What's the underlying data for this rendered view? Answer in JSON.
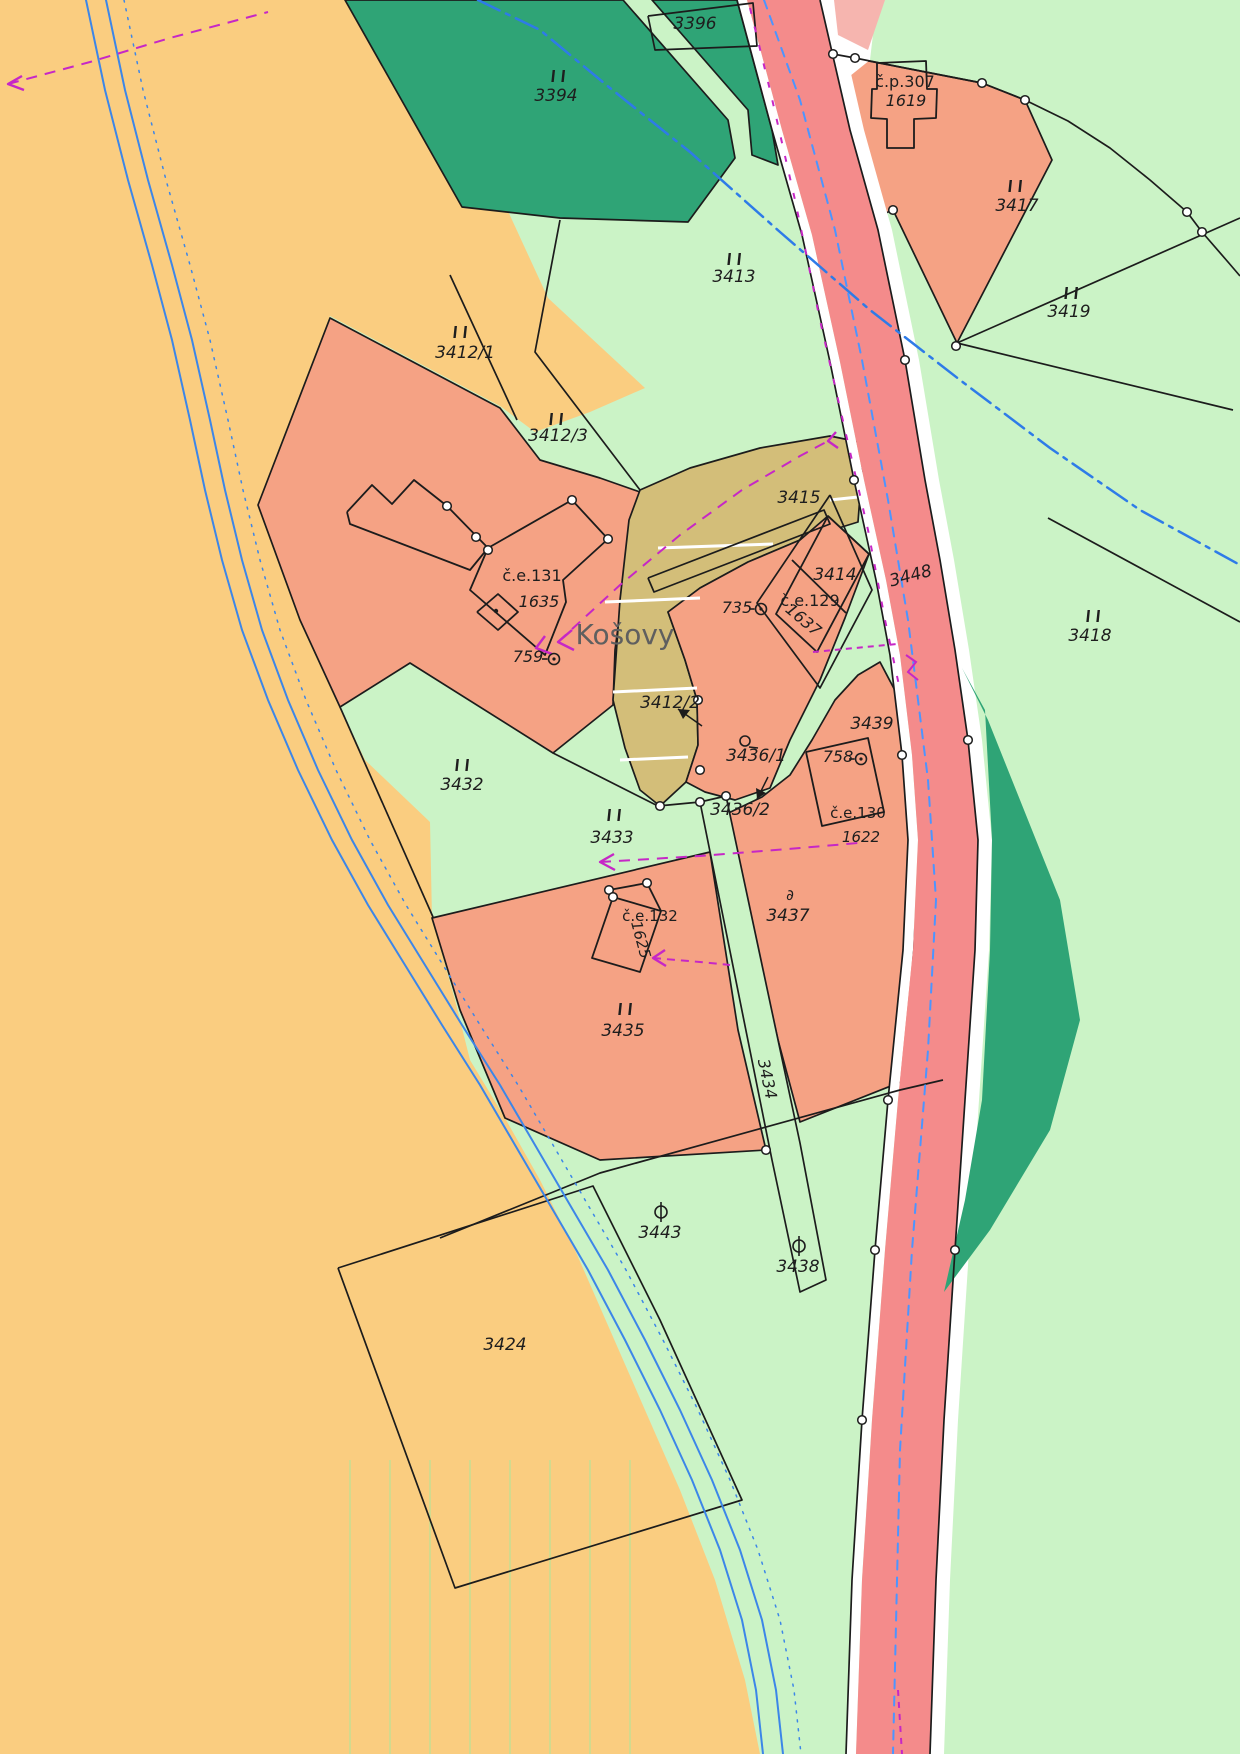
{
  "map": {
    "name": "cadastral-map",
    "place_name": "Košovy",
    "colors": {
      "base_green": "#CBF3C6",
      "field_yellow": "#FACD80",
      "parcel_orange": "#F5A284",
      "path_khaki": "#D3BE79",
      "forest_dark_green": "#2FA476",
      "road_pink": "#F48B8B",
      "road_pink_light": "#F6B5AF",
      "white": "#FFFFFF",
      "boundary_black": "#1c1c1c",
      "water_blue": "#3C86E8",
      "road_axis_blue": "#4C95FF",
      "pipeline_blue": "#2E7BE8",
      "utility_magenta": "#C627C6",
      "label_dark": "#1e1e1e",
      "placename_gray": "#5f5f5f"
    }
  },
  "regions": [
    {
      "name": "field-3424-area",
      "fill": "#FACD80",
      "pts": "0,0 345,0 462,207 507,209 548,298 645,388 590,412 535,432 500,406 330,316 258,505 300,620 340,707 365,760 430,822 432,918 455,1000 470,1060 505,1118 540,1180 575,1250 610,1330 645,1410 680,1490 715,1580 745,1680 760,1754 0,1754",
      "stroke": false
    },
    {
      "name": "forest-3394",
      "fill": "#2FA476",
      "pts": "345,0 623,0 728,120 735,158 688,222 560,218 462,207",
      "stroke": true
    },
    {
      "name": "forest-3396",
      "fill": "#2FA476",
      "pts": "652,0 737,0 772,130 778,165 752,155 748,110",
      "stroke": true
    },
    {
      "name": "parcel-3412-orange",
      "fill": "#F5A284",
      "pts": "258,505 330,318 500,408 540,460 600,478 640,492 627,560 615,650 613,705 553,753 410,663 340,707 300,620",
      "stroke": true
    },
    {
      "name": "path-3415-khaki",
      "fill": "#D3BE79",
      "pts": "640,490 690,468 760,448 830,436 864,443 858,522 800,540 748,562 700,588 668,612 685,660 697,700 698,745 686,782 660,806 640,790 625,748 613,700 620,600 629,520",
      "stroke": true
    },
    {
      "name": "parcel-3436-1-orange",
      "fill": "#F5A284",
      "pts": "668,612 685,660 697,700 698,745 686,782 705,792 735,800 770,788 790,740 820,680 845,618 869,554 828,516 800,540 748,562 700,588",
      "stroke": true
    },
    {
      "name": "parcel-3437-orange",
      "fill": "#F5A284",
      "pts": "880,662 900,700 908,770 913,860 913,980 906,1080 800,1122 778,1040 755,940 730,855 718,818 762,797 790,775 812,740 835,700 858,675",
      "stroke": true
    },
    {
      "name": "parcel-3435-orange",
      "fill": "#F5A284",
      "pts": "432,918 710,852 738,1030 766,1150 600,1160 505,1118 460,1010",
      "stroke": true
    },
    {
      "name": "parcel-3417-orange",
      "fill": "#F5A284",
      "pts": "833,54 982,83 1025,100 1052,160 957,343 893,210 850,228 820,170 815,105",
      "stroke": true
    },
    {
      "name": "path-3434-strip",
      "fill": "#CBF3C6",
      "pts": "700,802 726,796 800,1143 826,1280 800,1292 772,1160",
      "stroke": true
    },
    {
      "name": "road-white-left",
      "fill": "#FFFFFF",
      "pts": "737,0 772,130 802,235 830,362 854,480 876,580 890,655 902,755 908,840 903,950 888,1100 875,1250 862,1420 852,1580 846,1754 856,1754 862,1580 872,1420 885,1250 898,1100 913,950 918,840 912,755 900,655 886,580 864,480 840,362 812,235 782,130 747,0",
      "stroke": false
    },
    {
      "name": "road-white-right",
      "fill": "#FFFFFF",
      "pts": "820,0 850,130 878,230 905,360 925,480 940,560 955,650 968,740 978,840 975,950 965,1100 955,1250 944,1420 936,1580 930,1754 944,1754 950,1580 958,1420 969,1250 979,1100 989,950 992,840 982,740 969,650 954,560 939,480 919,360 892,230 864,130 834,0",
      "stroke": false
    },
    {
      "name": "road-white-top",
      "fill": "#FFFFFF",
      "pts": "834,0 877,0 870,60 845,80 838,40",
      "stroke": false
    },
    {
      "name": "road-pink",
      "fill": "#F48B8B",
      "pts": "747,0 782,130 812,235 840,362 864,480 886,580 900,655 912,755 918,840 913,950 898,1100 885,1250 872,1420 862,1580 856,1754 930,1754 936,1580 944,1420 955,1250 965,1100 975,950 978,840 968,740 955,650 940,560 925,480 905,360 878,230 850,130 820,0",
      "stroke": false
    },
    {
      "name": "road-pink-light",
      "fill": "#F6B5AF",
      "pts": "834,0 885,0 868,50 838,35",
      "stroke": false
    },
    {
      "name": "forest-strip-right",
      "fill": "#2FA476",
      "pts": "962,668 985,710 992,840 990,950 982,1100 965,1200 944,1292 990,1230 1050,1130 1080,1020 1060,900 1020,800 988,720",
      "stroke": false
    }
  ],
  "white_steps": [
    "605,602 700,598",
    "613,692 697,688",
    "620,760 688,757",
    "658,548 773,544",
    "830,500 858,497"
  ],
  "black_lines": [
    {
      "name": "boundary-road-left",
      "pts": "737,0 772,130 802,235 830,362 854,480 876,580 890,655 902,755 908,840 903,950 888,1100 875,1250 862,1420 852,1580 846,1754"
    },
    {
      "name": "boundary-road-right",
      "pts": "820,0 850,130 878,230 905,360 925,480 940,560 955,650 968,740 978,840 975,950 965,1100 955,1250 944,1420 936,1580 930,1754"
    },
    {
      "name": "quad-3396",
      "pts": "648,16 753,3 757,46 655,50 648,16"
    },
    {
      "name": "fan-arc-3417",
      "pts": "833,54 855,58 900,67 982,83 1025,100 1068,121 1110,148 1150,180 1187,212 1202,232 1228,262 1240,276"
    },
    {
      "name": "line-3419-north",
      "pts": "957,343 1240,218"
    },
    {
      "name": "line-3419-south",
      "pts": "957,343 1233,410"
    },
    {
      "name": "line-3418-ne",
      "pts": "1048,518 1240,622"
    },
    {
      "name": "line-3413-west",
      "pts": "560,220 535,352 640,490"
    },
    {
      "name": "line-3412-split",
      "pts": "450,275 517,420"
    },
    {
      "name": "line-bottom-cross",
      "pts": "440,1238 600,1173 900,1090 943,1080"
    },
    {
      "name": "outline-3424",
      "pts": "338,1268 593,1186 660,1320 742,1500 455,1588 338,1268"
    },
    {
      "name": "line-3432-3433",
      "pts": "340,707 433,917"
    },
    {
      "name": "line-3433-north",
      "pts": "553,753 658,806 700,802"
    },
    {
      "name": "footbridge-khaki",
      "pts": "648,578 824,510 830,524 654,592 648,578"
    },
    {
      "name": "diamond-3414",
      "pts": "830,495 872,590 820,688 757,603 830,495"
    }
  ],
  "buildings": [
    {
      "name": "building-cp307",
      "pts": "877,63 926,61 927,89 937,89 936,118 914,119 914,148 887,148 887,119 871,118 872,89 877,89 877,63"
    },
    {
      "name": "building-ce131-arm",
      "pts": "347,512 372,485 392,504 414,480 447,506 488,548 470,570 350,524 347,512"
    },
    {
      "name": "building-ce131-main",
      "pts": "488,548 572,500 608,539 563,580 566,602 545,655 470,590 488,548"
    },
    {
      "name": "building-ce131-annex",
      "pts": "477,612 498,594 518,612 498,630 477,612"
    },
    {
      "name": "building-ce129",
      "pts": "828,516 869,554 817,652 776,614 828,516"
    },
    {
      "name": "building-ce129-inner",
      "pts": "792,560 846,613"
    },
    {
      "name": "building-ce130",
      "pts": "806,752 868,738 884,812 822,826 806,752"
    },
    {
      "name": "building-ce132",
      "pts": "613,897 661,911 640,972 592,958 613,897"
    },
    {
      "name": "building-ce132-ridge",
      "pts": "609,890 647,883 661,911"
    }
  ],
  "blue_lines": [
    {
      "name": "stream-bank-west",
      "pts": "86,0 105,90 128,180 152,265 172,340 190,420 205,490 222,560 242,630 268,700 298,770 332,840 368,905 405,965 442,1025 480,1085 515,1145 550,1205 588,1270 625,1340 660,1410 692,1480 720,1550 742,1620 756,1690 763,1754",
      "dash": "",
      "w": 2
    },
    {
      "name": "stream-bank-east",
      "pts": "106,0 125,90 148,180 172,265 192,340 210,420 225,490 242,560 262,630 288,700 318,770 352,840 388,905 425,965 462,1025 500,1085 535,1145 570,1205 608,1270 645,1340 680,1410 712,1480 740,1550 762,1620 776,1690 783,1754",
      "dash": "",
      "w": 2
    },
    {
      "name": "stream-parcel-dotted",
      "pts": "124,0 143,90 166,180 190,265 210,340 228,420 243,490 260,560 280,630 306,700 336,770 370,840 406,905 443,965 480,1025 518,1085 553,1145 588,1205 626,1270 663,1340 698,1410 730,1480 758,1550 780,1620 794,1690 801,1754",
      "dash": "2,7",
      "w": 1.5
    },
    {
      "name": "pipeline-dashdot",
      "pts": "478,0 540,30 610,88 690,152 780,232 870,310 960,380 1050,448 1140,510 1240,565",
      "dash": "24,7,4,7",
      "w": 2.5
    },
    {
      "name": "road-axis-dashed",
      "pts": "764,0 800,100 835,230 862,360 888,500 908,620 928,780 936,900 928,1050 912,1250 900,1450 893,1754",
      "dash": "9,8",
      "w": 2
    }
  ],
  "magenta_lines": [
    {
      "name": "utility-kosovy",
      "pts": "558,642 620,585 680,535 742,490 800,456 828,441",
      "dash": "11,8"
    },
    {
      "name": "utility-3437",
      "pts": "600,862 700,856 800,848 858,843",
      "dash": "11,8"
    },
    {
      "name": "utility-1625",
      "pts": "653,958 700,962 730,965",
      "dash": "8,6"
    },
    {
      "name": "utility-topleft",
      "pts": "8,84 90,62 170,38 268,12",
      "dash": "11,8"
    },
    {
      "name": "utility-road-edge",
      "pts": "750,8 770,90 795,200 820,320 845,430 868,530 885,620 900,690",
      "dash": "6,13"
    },
    {
      "name": "utility-3439",
      "pts": "813,652 897,644",
      "dash": "6,5"
    },
    {
      "name": "utility-road-bottom",
      "pts": "898,1690 902,1754",
      "dash": "6,6"
    },
    {
      "name": "utility-zigzag",
      "pts": "906,655 916,662 908,672 918,680",
      "dash": ""
    }
  ],
  "magenta_arrows": [
    {
      "name": "arrow-kosovy",
      "pts": "572,630 558,642 574,650"
    },
    {
      "name": "arrow-kosovy-tip",
      "pts": "545,636 536,648 552,654"
    },
    {
      "name": "arrow-m1-end",
      "pts": "838,448 828,441 836,432"
    },
    {
      "name": "arrow-3437",
      "pts": "614,854 600,862 615,870"
    },
    {
      "name": "arrow-1625",
      "pts": "665,950 653,958 666,966"
    },
    {
      "name": "arrow-topleft",
      "pts": "22,76 8,84 24,90"
    }
  ],
  "black_arrows": [
    {
      "name": "arrow-3412-2",
      "pts": "702,726 678,709",
      "head": "678,709 690,710 683,719"
    },
    {
      "name": "arrow-3436-2",
      "pts": "768,777 757,799",
      "head": "757,799 756,788 766,793"
    }
  ],
  "circles": [
    [
      572,
      500
    ],
    [
      608,
      539
    ],
    [
      476,
      537
    ],
    [
      488,
      550
    ],
    [
      447,
      506
    ],
    [
      609,
      890
    ],
    [
      647,
      883
    ],
    [
      833,
      54
    ],
    [
      855,
      58
    ],
    [
      982,
      83
    ],
    [
      1025,
      100
    ],
    [
      1187,
      212
    ],
    [
      1202,
      232
    ],
    [
      956,
      346
    ],
    [
      893,
      210
    ],
    [
      700,
      802
    ],
    [
      726,
      796
    ],
    [
      766,
      1150
    ],
    [
      698,
      700
    ],
    [
      700,
      770
    ],
    [
      854,
      480
    ],
    [
      902,
      755
    ],
    [
      888,
      1100
    ],
    [
      875,
      1250
    ],
    [
      862,
      1420
    ],
    [
      905,
      360
    ],
    [
      968,
      740
    ],
    [
      955,
      1250
    ],
    [
      660,
      806
    ],
    [
      613,
      897
    ]
  ],
  "grass_symbols": [
    [
      558,
      76
    ],
    [
      1015,
      186
    ],
    [
      734,
      259
    ],
    [
      1071,
      293
    ],
    [
      460,
      332
    ],
    [
      556,
      419
    ],
    [
      1093,
      616
    ],
    [
      462,
      765
    ],
    [
      614,
      815
    ],
    [
      625,
      1009
    ]
  ],
  "point_symbols": [
    {
      "type": "dotcircle",
      "x": 761,
      "y": 609
    },
    {
      "type": "dotcircle",
      "x": 861,
      "y": 759
    },
    {
      "type": "dotcircle",
      "x": 554,
      "y": 659
    },
    {
      "type": "smallcircle",
      "x": 745,
      "y": 741
    },
    {
      "type": "theta",
      "x": 661,
      "y": 1212
    },
    {
      "type": "theta",
      "x": 799,
      "y": 1246
    },
    {
      "type": "dsym",
      "x": 790,
      "y": 900
    }
  ],
  "labels": [
    {
      "t": "3396",
      "x": 695,
      "y": 29,
      "s": 17,
      "r": 0,
      "c": "#1e1e1e",
      "i": true
    },
    {
      "t": "3394",
      "x": 556,
      "y": 101,
      "s": 17,
      "r": 0,
      "c": "#1e1e1e",
      "i": true
    },
    {
      "t": "č.p.307",
      "x": 905,
      "y": 87,
      "s": 16,
      "r": 0,
      "c": "#1e1e1e",
      "i": false
    },
    {
      "t": "1619",
      "x": 906,
      "y": 106,
      "s": 16,
      "r": 0,
      "c": "#1e1e1e",
      "i": true
    },
    {
      "t": "3417",
      "x": 1017,
      "y": 211,
      "s": 17,
      "r": 0,
      "c": "#1e1e1e",
      "i": true
    },
    {
      "t": "3413",
      "x": 734,
      "y": 282,
      "s": 17,
      "r": 0,
      "c": "#1e1e1e",
      "i": true
    },
    {
      "t": "3419",
      "x": 1069,
      "y": 317,
      "s": 17,
      "r": 0,
      "c": "#1e1e1e",
      "i": true
    },
    {
      "t": "3412/1",
      "x": 465,
      "y": 358,
      "s": 17,
      "r": 0,
      "c": "#1e1e1e",
      "i": true
    },
    {
      "t": "3412/3",
      "x": 558,
      "y": 441,
      "s": 17,
      "r": 0,
      "c": "#1e1e1e",
      "i": true
    },
    {
      "t": "3415",
      "x": 799,
      "y": 503,
      "s": 17,
      "r": 0,
      "c": "#1e1e1e",
      "i": true
    },
    {
      "t": "3414",
      "x": 835,
      "y": 580,
      "s": 17,
      "r": 0,
      "c": "#1e1e1e",
      "i": true
    },
    {
      "t": "3448",
      "x": 912,
      "y": 581,
      "s": 17,
      "r": -15,
      "c": "#1e1e1e",
      "i": true
    },
    {
      "t": "č.e.131",
      "x": 532,
      "y": 581,
      "s": 16,
      "r": 0,
      "c": "#1e1e1e",
      "i": false
    },
    {
      "t": "1635",
      "x": 539,
      "y": 607,
      "s": 16,
      "r": 0,
      "c": "#1e1e1e",
      "i": true
    },
    {
      "t": "735",
      "x": 737,
      "y": 613,
      "s": 16,
      "r": 0,
      "c": "#1e1e1e",
      "i": true
    },
    {
      "t": "č.e.129",
      "x": 810,
      "y": 606,
      "s": 16,
      "r": 0,
      "c": "#1e1e1e",
      "i": false
    },
    {
      "t": "1637",
      "x": 800,
      "y": 624,
      "s": 16,
      "r": 40,
      "c": "#1e1e1e",
      "i": true
    },
    {
      "t": "3418",
      "x": 1090,
      "y": 641,
      "s": 17,
      "r": 0,
      "c": "#1e1e1e",
      "i": true
    },
    {
      "t": "Košovy",
      "x": 625,
      "y": 644,
      "s": 28,
      "r": 0,
      "c": "#5f5f5f",
      "i": false
    },
    {
      "t": "759",
      "x": 528,
      "y": 662,
      "s": 16,
      "r": 0,
      "c": "#1e1e1e",
      "i": true
    },
    {
      "t": "3412/2",
      "x": 670,
      "y": 708,
      "s": 17,
      "r": 0,
      "c": "#1e1e1e",
      "i": true
    },
    {
      "t": "3436/1",
      "x": 756,
      "y": 761,
      "s": 17,
      "r": 0,
      "c": "#1e1e1e",
      "i": true
    },
    {
      "t": "3439",
      "x": 872,
      "y": 729,
      "s": 17,
      "r": 0,
      "c": "#1e1e1e",
      "i": true
    },
    {
      "t": "758",
      "x": 838,
      "y": 762,
      "s": 16,
      "r": 0,
      "c": "#1e1e1e",
      "i": true
    },
    {
      "t": "3432",
      "x": 462,
      "y": 790,
      "s": 17,
      "r": 0,
      "c": "#1e1e1e",
      "i": true
    },
    {
      "t": "č.e.130",
      "x": 858,
      "y": 818,
      "s": 15,
      "r": 0,
      "c": "#1e1e1e",
      "i": false
    },
    {
      "t": "1622",
      "x": 861,
      "y": 842,
      "s": 15,
      "r": 0,
      "c": "#1e1e1e",
      "i": true
    },
    {
      "t": "3433",
      "x": 612,
      "y": 843,
      "s": 17,
      "r": 0,
      "c": "#1e1e1e",
      "i": true
    },
    {
      "t": "3436/2",
      "x": 740,
      "y": 815,
      "s": 17,
      "r": 0,
      "c": "#1e1e1e",
      "i": true
    },
    {
      "t": "č.e.132",
      "x": 650,
      "y": 921,
      "s": 15,
      "r": 0,
      "c": "#1e1e1e",
      "i": false
    },
    {
      "t": "1625",
      "x": 636,
      "y": 941,
      "s": 15,
      "r": 75,
      "c": "#1e1e1e",
      "i": true
    },
    {
      "t": "3437",
      "x": 788,
      "y": 921,
      "s": 17,
      "r": 0,
      "c": "#1e1e1e",
      "i": true
    },
    {
      "t": "3435",
      "x": 623,
      "y": 1036,
      "s": 17,
      "r": 0,
      "c": "#1e1e1e",
      "i": true
    },
    {
      "t": "3434",
      "x": 762,
      "y": 1080,
      "s": 16,
      "r": 78,
      "c": "#1e1e1e",
      "i": true
    },
    {
      "t": "3443",
      "x": 660,
      "y": 1238,
      "s": 17,
      "r": 0,
      "c": "#1e1e1e",
      "i": true
    },
    {
      "t": "3438",
      "x": 798,
      "y": 1272,
      "s": 17,
      "r": 0,
      "c": "#1e1e1e",
      "i": true
    },
    {
      "t": "3424",
      "x": 505,
      "y": 1350,
      "s": 17,
      "r": 0,
      "c": "#1e1e1e",
      "i": true
    }
  ]
}
